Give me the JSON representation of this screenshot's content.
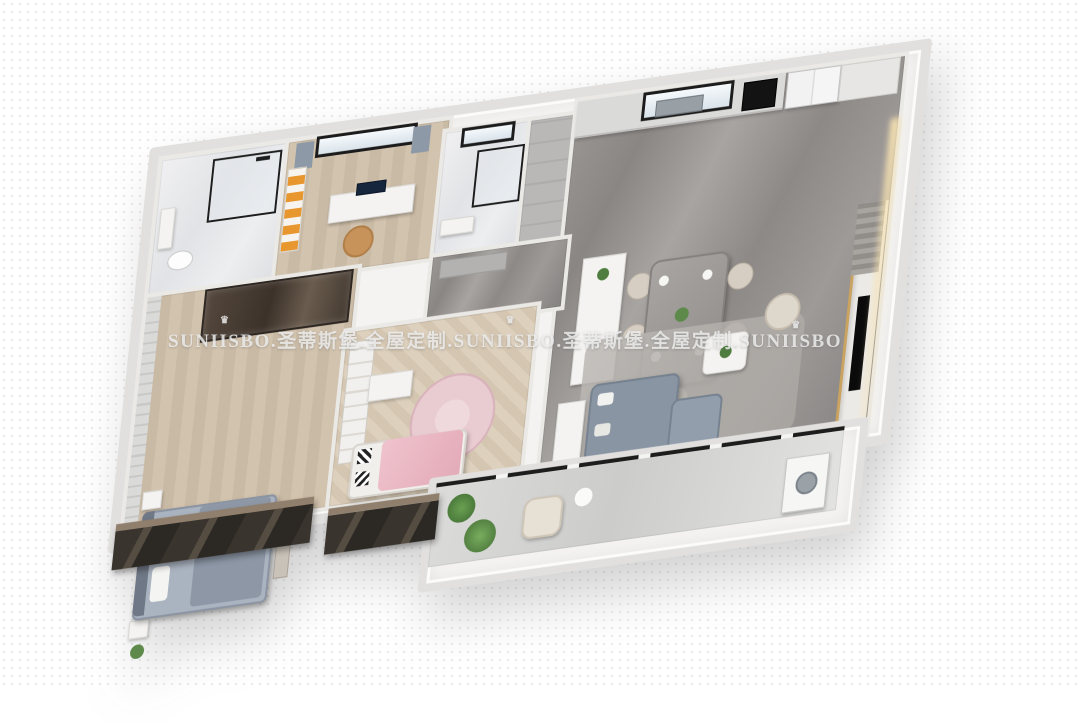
{
  "watermark": {
    "full_text": "SUNIISBO.圣蒂斯堡.全屋定制.SUNIISBO.圣蒂斯堡.全屋定制.SUNIISBO",
    "segments": [
      {
        "brand": "SUNIISBO",
        "suffix": ".圣蒂斯堡.全屋定制."
      },
      {
        "brand": "SUNIISBO",
        "suffix": ".圣蒂斯堡.全屋定制."
      },
      {
        "brand": "SUNIISBO",
        "suffix": ""
      }
    ],
    "crown_icon": "♛",
    "color": "#ededed"
  },
  "palette": {
    "background": "#ffffff",
    "outer_wall": "#e1e0de",
    "marble_floor": "#928e8c",
    "light_marble": "#e8e9ec",
    "wood_floor": "#cfc2af",
    "herringbone_floor": "#d9cdbb",
    "accent_orange": "#e8962e",
    "accent_gold": "#c9a35f",
    "sofa_gray": "#8a95a3",
    "bed_blue_gray": "#aab3c0",
    "pink_blanket": "#e8b9c3",
    "plant_green": "#4f7d3f",
    "dark_window": "#35302b"
  },
  "scene": {
    "type": "3d-apartment-floorplan-render",
    "rooms": [
      {
        "id": "bathroom-main",
        "name": "bathroom",
        "furniture": [
          "shower-enclosure",
          "toilet",
          "vanity"
        ]
      },
      {
        "id": "study",
        "name": "study-bedroom",
        "furniture": [
          "window",
          "curtains",
          "bookshelf",
          "desk",
          "monitor",
          "armchair"
        ]
      },
      {
        "id": "bathroom-small",
        "name": "bathroom",
        "furniture": [
          "window",
          "shower",
          "vanity"
        ]
      },
      {
        "id": "entry-closet",
        "name": "entry-closet",
        "furniture": [
          "cabinet"
        ]
      },
      {
        "id": "kitchen",
        "name": "kitchen",
        "furniture": [
          "counter",
          "window",
          "sink",
          "oven",
          "refrigerator",
          "pantry-cabinet"
        ]
      },
      {
        "id": "hallway",
        "name": "entry-hall",
        "furniture": [
          "shoe-cabinet"
        ]
      },
      {
        "id": "master-bedroom",
        "name": "master-bedroom",
        "furniture": [
          "wardrobe",
          "double-bed",
          "nightstand",
          "bench"
        ]
      },
      {
        "id": "kids-bedroom",
        "name": "kids-bedroom",
        "furniture": [
          "bookshelf",
          "desk",
          "round-rug",
          "pink-bed"
        ]
      },
      {
        "id": "dining-area",
        "name": "dining-area",
        "furniture": [
          "kitchen-island",
          "dining-table",
          "dining-chairs"
        ]
      },
      {
        "id": "living-room",
        "name": "living-room",
        "furniture": [
          "rug",
          "console-table",
          "sofa",
          "chaise",
          "coffee-table",
          "accent-chair",
          "tv-feature-wall",
          "tv"
        ]
      },
      {
        "id": "balcony",
        "name": "balcony",
        "furniture": [
          "plants",
          "lounge-chair",
          "side-table",
          "washing-machine"
        ]
      }
    ]
  }
}
